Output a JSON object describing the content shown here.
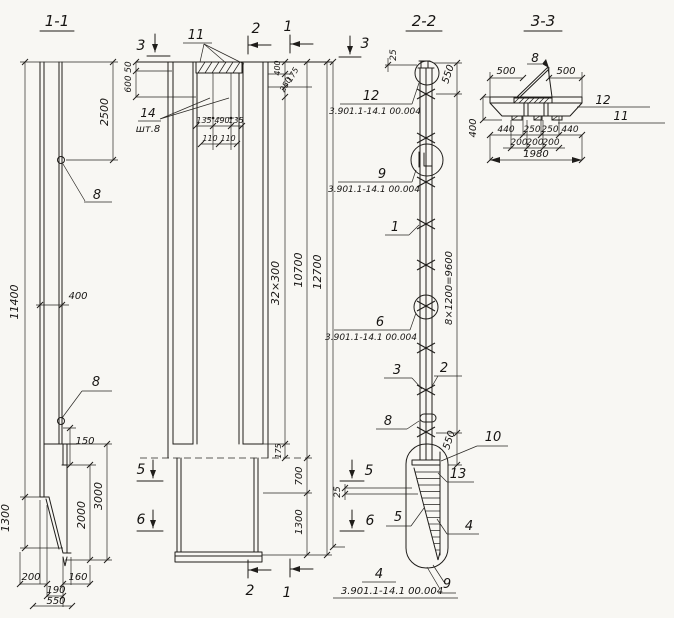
{
  "document": {
    "type": "structural-drawing",
    "background": "#f8f7f3",
    "ink_color": "#1f1d1a",
    "section_titles": [
      "1-1",
      "2-2",
      "3-3"
    ],
    "series_reference": "3.901.1-14.1 00.004"
  },
  "annotations": [
    {
      "id": "title-1-1",
      "text": "1-1",
      "x": 57,
      "y": 26,
      "rot": 0,
      "size": 15
    },
    {
      "id": "title-2-2",
      "text": "2-2",
      "x": 424,
      "y": 26,
      "rot": 0,
      "size": 15
    },
    {
      "id": "title-3-3",
      "text": "3-3",
      "x": 543,
      "y": 26,
      "rot": 0,
      "size": 15
    },
    {
      "id": "dim-11400",
      "text": "11400",
      "x": 18,
      "y": 302,
      "rot": -90,
      "size": 11
    },
    {
      "id": "dim-2500",
      "text": "2500",
      "x": 108,
      "y": 112,
      "rot": -90,
      "size": 11
    },
    {
      "id": "callout-8-upper",
      "text": "8",
      "x": 97,
      "y": 199,
      "rot": 0,
      "size": 13
    },
    {
      "id": "dim-400-shaft",
      "text": "400",
      "x": 78,
      "y": 299,
      "rot": 0,
      "size": 10
    },
    {
      "id": "callout-8-lower",
      "text": "8",
      "x": 96,
      "y": 386,
      "rot": 0,
      "size": 13
    },
    {
      "id": "dim-150",
      "text": "150",
      "x": 85,
      "y": 444,
      "rot": 0,
      "size": 10
    },
    {
      "id": "dim-3000",
      "text": "3000",
      "x": 102,
      "y": 496,
      "rot": -90,
      "size": 11
    },
    {
      "id": "dim-2000",
      "text": "2000",
      "x": 85,
      "y": 515,
      "rot": -90,
      "size": 11
    },
    {
      "id": "dim-1300-tip",
      "text": "1300",
      "x": 9,
      "y": 518,
      "rot": -90,
      "size": 11
    },
    {
      "id": "dim-200-toe",
      "text": "200",
      "x": 31,
      "y": 580,
      "rot": 0,
      "size": 10
    },
    {
      "id": "dim-160-toe",
      "text": "160",
      "x": 78,
      "y": 580,
      "rot": 0,
      "size": 10
    },
    {
      "id": "dim-190-toe",
      "text": "190",
      "x": 56,
      "y": 593,
      "rot": 0,
      "size": 10
    },
    {
      "id": "dim-550-toe",
      "text": "550",
      "x": 56,
      "y": 604,
      "rot": 0,
      "size": 10
    },
    {
      "id": "section-mark-3-top",
      "text": "3",
      "x": 141,
      "y": 50,
      "rot": 0,
      "size": 14
    },
    {
      "id": "callout-11",
      "text": "11",
      "x": 196,
      "y": 39,
      "rot": 0,
      "size": 13
    },
    {
      "id": "section-mark-2-top",
      "text": "2",
      "x": 256,
      "y": 33,
      "rot": 0,
      "size": 14
    },
    {
      "id": "section-mark-1-top",
      "text": "1",
      "x": 288,
      "y": 31,
      "rot": 0,
      "size": 14
    },
    {
      "id": "dim-50",
      "text": "50",
      "x": 131,
      "y": 67,
      "rot": -90,
      "size": 9
    },
    {
      "id": "dim-600",
      "text": "600",
      "x": 131,
      "y": 84,
      "rot": -90,
      "size": 9
    },
    {
      "id": "callout-14",
      "text": "14",
      "x": 148,
      "y": 117,
      "rot": 0,
      "size": 12
    },
    {
      "id": "callout-14-qty",
      "text": "шт.8",
      "x": 148,
      "y": 132,
      "rot": 0,
      "size": 10
    },
    {
      "id": "dim-135-left",
      "text": "135",
      "x": 204,
      "y": 123,
      "rot": 0,
      "size": 8
    },
    {
      "id": "dim-490",
      "text": "490",
      "x": 222,
      "y": 123,
      "rot": 0,
      "size": 8
    },
    {
      "id": "dim-135-right",
      "text": "135",
      "x": 236,
      "y": 123,
      "rot": 0,
      "size": 8
    },
    {
      "id": "dim-110-left",
      "text": "110",
      "x": 210,
      "y": 141,
      "rot": 0,
      "size": 8
    },
    {
      "id": "dim-110-right",
      "text": "110",
      "x": 228,
      "y": 141,
      "rot": 0,
      "size": 8
    },
    {
      "id": "dim-400-head",
      "text": "400",
      "x": 280,
      "y": 68,
      "rot": -90,
      "size": 8
    },
    {
      "id": "dim-250-head",
      "text": "250",
      "x": 288,
      "y": 86,
      "rot": -60,
      "size": 8
    },
    {
      "id": "dim-175-head",
      "text": "175",
      "x": 295,
      "y": 76,
      "rot": -60,
      "size": 8
    },
    {
      "id": "dim-32x300",
      "text": "32×300",
      "x": 279,
      "y": 283,
      "rot": -90,
      "size": 11
    },
    {
      "id": "dim-10700",
      "text": "10700",
      "x": 302,
      "y": 270,
      "rot": -90,
      "size": 11
    },
    {
      "id": "dim-12700",
      "text": "12700",
      "x": 321,
      "y": 272,
      "rot": -90,
      "size": 11
    },
    {
      "id": "dim-175-toe-mid",
      "text": "175",
      "x": 281,
      "y": 451,
      "rot": -90,
      "size": 8
    },
    {
      "id": "dim-700",
      "text": "700",
      "x": 302,
      "y": 476,
      "rot": -90,
      "size": 10
    },
    {
      "id": "dim-1300-shaft",
      "text": "1300",
      "x": 302,
      "y": 522,
      "rot": -90,
      "size": 10
    },
    {
      "id": "section-mark-5-left",
      "text": "5",
      "x": 141,
      "y": 474,
      "rot": 0,
      "size": 14
    },
    {
      "id": "section-mark-6-left",
      "text": "6",
      "x": 141,
      "y": 524,
      "rot": 0,
      "size": 14
    },
    {
      "id": "section-mark-2-bottom",
      "text": "2",
      "x": 250,
      "y": 595,
      "rot": 0,
      "size": 14
    },
    {
      "id": "section-mark-1-bottom",
      "text": "1",
      "x": 287,
      "y": 597,
      "rot": 0,
      "size": 14
    },
    {
      "id": "section-mark-3-22",
      "text": "3",
      "x": 365,
      "y": 48,
      "rot": 0,
      "size": 14
    },
    {
      "id": "dim-25-head",
      "text": "25",
      "x": 396,
      "y": 55,
      "rot": -90,
      "size": 9
    },
    {
      "id": "dim-550-head",
      "text": "550",
      "x": 451,
      "y": 75,
      "rot": -72,
      "size": 10
    },
    {
      "id": "callout-12-22",
      "text": "12",
      "x": 371,
      "y": 100,
      "rot": 0,
      "size": 13
    },
    {
      "id": "ref-series-12",
      "text": "3.901.1-14.1 00.004",
      "x": 375,
      "y": 114,
      "rot": 0,
      "size": 9
    },
    {
      "id": "callout-9-22",
      "text": "9",
      "x": 382,
      "y": 178,
      "rot": 0,
      "size": 13
    },
    {
      "id": "ref-series-9",
      "text": "3.901.1-14.1 00.004",
      "x": 374,
      "y": 192,
      "rot": 0,
      "size": 9
    },
    {
      "id": "callout-1-22",
      "text": "1",
      "x": 395,
      "y": 231,
      "rot": 0,
      "size": 13
    },
    {
      "id": "callout-6-22",
      "text": "6",
      "x": 380,
      "y": 326,
      "rot": 0,
      "size": 13
    },
    {
      "id": "ref-series-6",
      "text": "3.901.1-14.1 00.004",
      "x": 371,
      "y": 340,
      "rot": 0,
      "size": 9
    },
    {
      "id": "dim-8x1200",
      "text": "8×1200=9600",
      "x": 452,
      "y": 288,
      "rot": -90,
      "size": 10
    },
    {
      "id": "callout-3-22",
      "text": "3",
      "x": 397,
      "y": 374,
      "rot": 0,
      "size": 13
    },
    {
      "id": "callout-2-22",
      "text": "2",
      "x": 444,
      "y": 372,
      "rot": 0,
      "size": 13
    },
    {
      "id": "callout-8-22",
      "text": "8",
      "x": 388,
      "y": 425,
      "rot": 0,
      "size": 13
    },
    {
      "id": "callout-10-22",
      "text": "10",
      "x": 493,
      "y": 441,
      "rot": 0,
      "size": 13
    },
    {
      "id": "dim-550-toe-22",
      "text": "550",
      "x": 452,
      "y": 441,
      "rot": -72,
      "size": 10
    },
    {
      "id": "callout-13-22",
      "text": "13",
      "x": 458,
      "y": 478,
      "rot": 0,
      "size": 13
    },
    {
      "id": "dim-25-toe",
      "text": "25",
      "x": 340,
      "y": 492,
      "rot": -90,
      "size": 9
    },
    {
      "id": "section-mark-5-22",
      "text": "5",
      "x": 369,
      "y": 475,
      "rot": 0,
      "size": 14
    },
    {
      "id": "section-mark-6-22",
      "text": "6",
      "x": 370,
      "y": 525,
      "rot": 0,
      "size": 14
    },
    {
      "id": "callout-5-22",
      "text": "5",
      "x": 398,
      "y": 521,
      "rot": 0,
      "size": 13
    },
    {
      "id": "callout-4-22",
      "text": "4",
      "x": 469,
      "y": 530,
      "rot": 0,
      "size": 13
    },
    {
      "id": "callout-4-bottom",
      "text": "4",
      "x": 379,
      "y": 578,
      "rot": 0,
      "size": 13
    },
    {
      "id": "ref-series-4",
      "text": "3.901.1-14.1 00.004",
      "x": 392,
      "y": 594,
      "rot": 0,
      "size": 10
    },
    {
      "id": "callout-9-bottom",
      "text": "9",
      "x": 447,
      "y": 588,
      "rot": 0,
      "size": 13
    },
    {
      "id": "callout-8-33",
      "text": "8",
      "x": 535,
      "y": 62,
      "rot": 0,
      "size": 12
    },
    {
      "id": "dim-500-left",
      "text": "500",
      "x": 506,
      "y": 74,
      "rot": 0,
      "size": 10
    },
    {
      "id": "dim-500-right",
      "text": "500",
      "x": 566,
      "y": 74,
      "rot": 0,
      "size": 10
    },
    {
      "id": "callout-12-33",
      "text": "12",
      "x": 603,
      "y": 104,
      "rot": 0,
      "size": 12
    },
    {
      "id": "callout-11-33",
      "text": "11",
      "x": 621,
      "y": 120,
      "rot": 0,
      "size": 12
    },
    {
      "id": "dim-400-33",
      "text": "400",
      "x": 476,
      "y": 128,
      "rot": -90,
      "size": 10
    },
    {
      "id": "dim-440-left",
      "text": "440",
      "x": 506,
      "y": 132,
      "rot": 0,
      "size": 9
    },
    {
      "id": "dim-250-left",
      "text": "250",
      "x": 532,
      "y": 132,
      "rot": 0,
      "size": 9
    },
    {
      "id": "dim-250-right",
      "text": "250",
      "x": 550,
      "y": 132,
      "rot": 0,
      "size": 9
    },
    {
      "id": "dim-440-right",
      "text": "440",
      "x": 570,
      "y": 132,
      "rot": 0,
      "size": 9
    },
    {
      "id": "dim-200-a",
      "text": "200",
      "x": 519,
      "y": 145,
      "rot": 0,
      "size": 9
    },
    {
      "id": "dim-200-b",
      "text": "200",
      "x": 535,
      "y": 145,
      "rot": 0,
      "size": 9
    },
    {
      "id": "dim-200-c",
      "text": "200",
      "x": 551,
      "y": 145,
      "rot": 0,
      "size": 9
    },
    {
      "id": "dim-1980",
      "text": "1980",
      "x": 536,
      "y": 157,
      "rot": 0,
      "size": 10
    }
  ]
}
